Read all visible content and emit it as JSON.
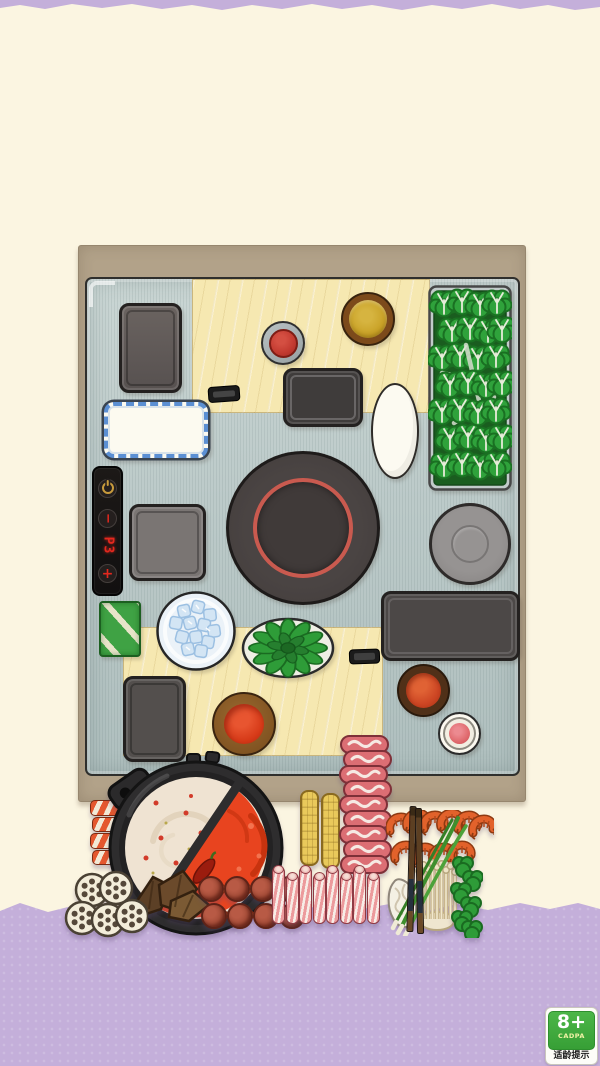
{
  "palette": {
    "background": "#FBF5E1",
    "floor": "#C4AFDA",
    "table_frame": "#B2A289",
    "table_surface": "#BFCCCB",
    "cutting_board": "#F6E8B1",
    "tray_dark": "#4C4847",
    "burner_ring_red": "#C95A4F",
    "led_red": "#E3281E",
    "power_gold": "#C89B3C",
    "broth_white": "#EFE3D2",
    "broth_red": "#E8441F",
    "leaf_green": "#2FA23B",
    "badge_green": "#3FA83C"
  },
  "control_panel": {
    "display_value": "P3",
    "minus_label": "−",
    "plus_label": "+"
  },
  "age_badge": {
    "rating": "8+",
    "org": "CADPA",
    "label": "适龄提示"
  },
  "scene_items": [
    "tray-top-left",
    "cutting-board-top",
    "red-sauce-cup",
    "mustard-sauce-bowl",
    "tray-top-center",
    "white-oval-plate",
    "lettuce-box",
    "blue-rim-plate",
    "whetstone",
    "control-panel",
    "square-tray",
    "induction-burner",
    "round-gray-plate",
    "wrapped-green-pack",
    "ice-plate",
    "cutting-board-bottom",
    "cilantro-plate",
    "small-handle",
    "large-dark-tray",
    "bottom-left-tray",
    "red-dip-bowl-center",
    "red-dip-bowl-right",
    "pink-dip-cup",
    "crab-sticks",
    "corn-cobs",
    "marbled-beef-stack",
    "split-hotpot",
    "shrimp-platter",
    "noodle-tangle",
    "enoki-mushrooms",
    "scallions",
    "broccoli",
    "chopsticks",
    "dried-mushrooms",
    "meatball-skewers",
    "sliced-meat-rolls",
    "lotus-root-slices",
    "age-rating-badge"
  ]
}
